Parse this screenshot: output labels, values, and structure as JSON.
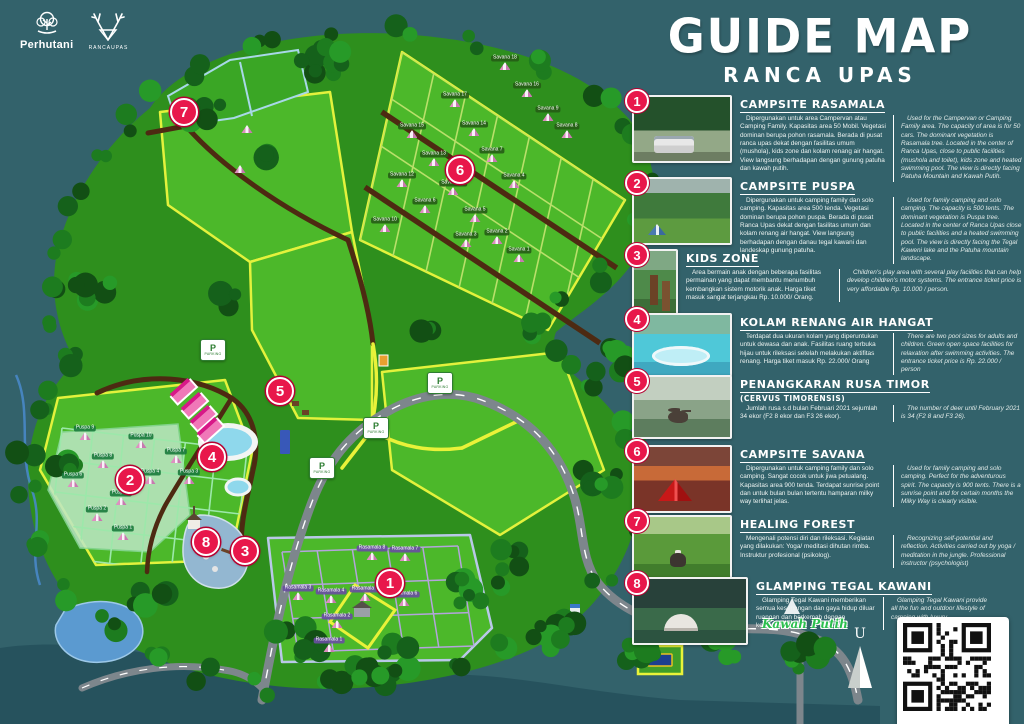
{
  "header": {
    "title": "GUIDE MAP",
    "subtitle": "RANCA UPAS"
  },
  "logos": {
    "perhutani": "Perhutani",
    "resort": "RANCAUPAS"
  },
  "legend": {
    "items": [
      {
        "num": "1",
        "title": "CAMPSITE RASAMALA",
        "id": "Dipergunakan untuk area Campervan atau Camping Family. Kapasitas area 50 Mobil. Vegetasi dominan berupa pohon rasamala. Berada di pusat ranca upas dekat dengan fasilitas umum (mushola), kids zone dan kolam renang air hangat. View langsung berhadapan dengan gunung patuha dan kawah putih.",
        "en": "Used for the Campervan or Camping Family area. The capacity of area is for 50 cars. The dominant vegetation is Rasamala tree. Located in the center of Ranca Upas, close to public facilities (mushola and toilet), kids zone and heated swimming pool. The view is directly facing Patuha Mountain and Kawah Putih."
      },
      {
        "num": "2",
        "title": "CAMPSITE PUSPA",
        "id": "Dipergunakan untuk camping family dan solo camping. Kapasitas area 500 tenda. Vegetasi dominan berupa pohon puspa. Berada di pusat Ranca Upas dekat dengan fasilitas umum dan kolam renang air hangat. View langsung berhadapan dengan danau tegal kawani dan landeskap gunung patuha.",
        "en": "Used for family camping and solo camping. The capacity is 500 tents. The dominant vegetation is Puspa tree. Located in the center of Ranca Upas close to public facilities and a heated swimming pool. The view is directly facing the Tegal Kaweni lake and the Patuha mountain landscape."
      },
      {
        "num": "3",
        "title": "KIDS ZONE",
        "id": "Area bermain anak dengan beberapa fasilitas permainan yang dapat membantu menumbuh kembangkan sistem motorik anak. Harga tiket masuk sangat terjangkau Rp. 10.000/ Orang.",
        "en": "Children's play area with several play facilities that can help develop children's motor systems. The entrance ticket price is very affordable Rp. 10.000 / person."
      },
      {
        "num": "4",
        "title": "KOLAM RENANG AIR HANGAT",
        "id": "Terdapat dua ukuran kolam yang diperuntukan untuk dewasa dan anak. Fasilitas ruang terbuka hijau untuk rileksasi setelah melakukan aktifitas renang. Harga tiket masuk Rp. 22.000/ Orang",
        "en": "There are two pool sizes for adults and children. Green open space facilities for relaxation after swimming activities. The entrance ticket price is Rp. 22.000 / person"
      },
      {
        "num": "5",
        "title": "PENANGKARAN RUSA TIMOR",
        "subtitle": "(CERVUS TIMORENSIS)",
        "id": "Jumlah rusa s.d bulan Februari 2021 sejumlah 34 ekor (F2 8 ekor dan F3 26 ekor).",
        "en": "The number of deer until February 2021 is 34 (F2 8 and F3 26)."
      },
      {
        "num": "6",
        "title": "CAMPSITE SAVANA",
        "id": "Dipergunakan untuk camping family dan solo camping. Sangat cocok untuk jiwa petualang. Kapasitas area 900 tenda. Terdapat sunrise point dan untuk bulan bulan tertentu hamparan milky way terlihat jelas.",
        "en": "Used for family camping and solo camping. Perfect for the adventurous spirit. The capacity is 900 tents. There is a sunrise point and for certain months the Milky Way is clearly visible."
      },
      {
        "num": "7",
        "title": "HEALING FOREST",
        "id": "Mengenali potensi diri dan rileksasi. Kegiatan yang dilakukan: Yoga/ meditasi dihutan rimba. Instruktur profesional (psikolog).",
        "en": "Recognizing self-potential and reflection. Activities carried out by yoga / meditation in the jungle. Professional instructor (psychologist)"
      },
      {
        "num": "8",
        "title": "GLAMPING TEGAL KAWANI",
        "id": "Glamping Tegal Kawani memberikan semua kesenangan dan gaya hidup diluar ruangan dan berkemah dengan kemewahan.",
        "en": "Glamping Tegal Kawani provide all the fun and outdoor lifestyle of camping with luxury."
      }
    ]
  },
  "map": {
    "markers": [
      {
        "n": "1",
        "x": 388,
        "y": 581
      },
      {
        "n": "2",
        "x": 128,
        "y": 478
      },
      {
        "n": "3",
        "x": 243,
        "y": 549
      },
      {
        "n": "4",
        "x": 210,
        "y": 455
      },
      {
        "n": "5",
        "x": 278,
        "y": 389
      },
      {
        "n": "6",
        "x": 458,
        "y": 168
      },
      {
        "n": "7",
        "x": 182,
        "y": 110
      },
      {
        "n": "8",
        "x": 204,
        "y": 540
      }
    ],
    "tents": [
      {
        "area": "savana",
        "label": "Savana 18",
        "x": 505,
        "y": 70
      },
      {
        "area": "savana",
        "label": "Savana 16",
        "x": 527,
        "y": 97
      },
      {
        "area": "savana",
        "label": "Savana 17",
        "x": 455,
        "y": 107
      },
      {
        "area": "savana",
        "label": "Savana 9",
        "x": 548,
        "y": 121
      },
      {
        "area": "savana",
        "label": "Savana 14",
        "x": 474,
        "y": 136
      },
      {
        "area": "savana",
        "label": "Savana 15",
        "x": 412,
        "y": 138
      },
      {
        "area": "savana",
        "label": "Savana 8",
        "x": 567,
        "y": 138
      },
      {
        "area": "savana",
        "label": "Savana 13",
        "x": 434,
        "y": 166
      },
      {
        "area": "savana",
        "label": "Savana 7",
        "x": 492,
        "y": 162
      },
      {
        "area": "savana",
        "label": "Savana 12",
        "x": 402,
        "y": 187
      },
      {
        "area": "savana",
        "label": "Savana 11",
        "x": 453,
        "y": 195
      },
      {
        "area": "savana",
        "label": "Savana 4",
        "x": 514,
        "y": 188
      },
      {
        "area": "savana",
        "label": "Savana 10",
        "x": 385,
        "y": 232
      },
      {
        "area": "savana",
        "label": "Savana 6",
        "x": 425,
        "y": 213
      },
      {
        "area": "savana",
        "label": "Savana 5",
        "x": 475,
        "y": 222
      },
      {
        "area": "savana",
        "label": "Savana 3",
        "x": 466,
        "y": 247
      },
      {
        "area": "savana",
        "label": "Savana 2",
        "x": 497,
        "y": 244
      },
      {
        "area": "savana",
        "label": "Savana 1",
        "x": 519,
        "y": 262
      },
      {
        "area": "puspa",
        "label": "Puspa 9",
        "x": 85,
        "y": 440
      },
      {
        "area": "puspa",
        "label": "Puspa 10",
        "x": 141,
        "y": 448
      },
      {
        "area": "puspa",
        "label": "Puspa 8",
        "x": 103,
        "y": 468
      },
      {
        "area": "puspa",
        "label": "Puspa 7",
        "x": 176,
        "y": 463
      },
      {
        "area": "puspa",
        "label": "Puspa 6",
        "x": 73,
        "y": 487
      },
      {
        "area": "puspa",
        "label": "Puspa 5",
        "x": 121,
        "y": 505
      },
      {
        "area": "puspa",
        "label": "Puspa 4",
        "x": 150,
        "y": 484
      },
      {
        "area": "puspa",
        "label": "Puspa 3",
        "x": 189,
        "y": 484
      },
      {
        "area": "puspa",
        "label": "Puspa 2",
        "x": 97,
        "y": 521
      },
      {
        "area": "puspa",
        "label": "Puspa 1",
        "x": 123,
        "y": 540
      },
      {
        "area": "rasamala",
        "label": "Rasamala 8",
        "x": 372,
        "y": 560
      },
      {
        "area": "rasamala",
        "label": "Rasamala 7",
        "x": 405,
        "y": 561
      },
      {
        "area": "rasamala",
        "label": "Rasamala 3",
        "x": 298,
        "y": 600
      },
      {
        "area": "rasamala",
        "label": "Rasamala 4",
        "x": 331,
        "y": 603
      },
      {
        "area": "rasamala",
        "label": "Rasamala 5",
        "x": 365,
        "y": 601
      },
      {
        "area": "rasamala",
        "label": "Rasamala 6",
        "x": 404,
        "y": 606
      },
      {
        "area": "rasamala",
        "label": "Rasamala 2",
        "x": 337,
        "y": 628
      },
      {
        "area": "rasamala",
        "label": "Rasamala 1",
        "x": 329,
        "y": 652
      },
      {
        "area": "other",
        "label": "",
        "x": 247,
        "y": 133
      },
      {
        "area": "other",
        "label": "",
        "x": 240,
        "y": 173
      }
    ],
    "parking": {
      "p": "P",
      "label": "PARKING",
      "spots": [
        {
          "x": 440,
          "y": 383
        },
        {
          "x": 376,
          "y": 428
        },
        {
          "x": 322,
          "y": 468
        },
        {
          "x": 213,
          "y": 350
        }
      ]
    },
    "signs": {
      "kawah_putih": "Kawah Putih"
    },
    "compass": {
      "label": "U"
    }
  }
}
